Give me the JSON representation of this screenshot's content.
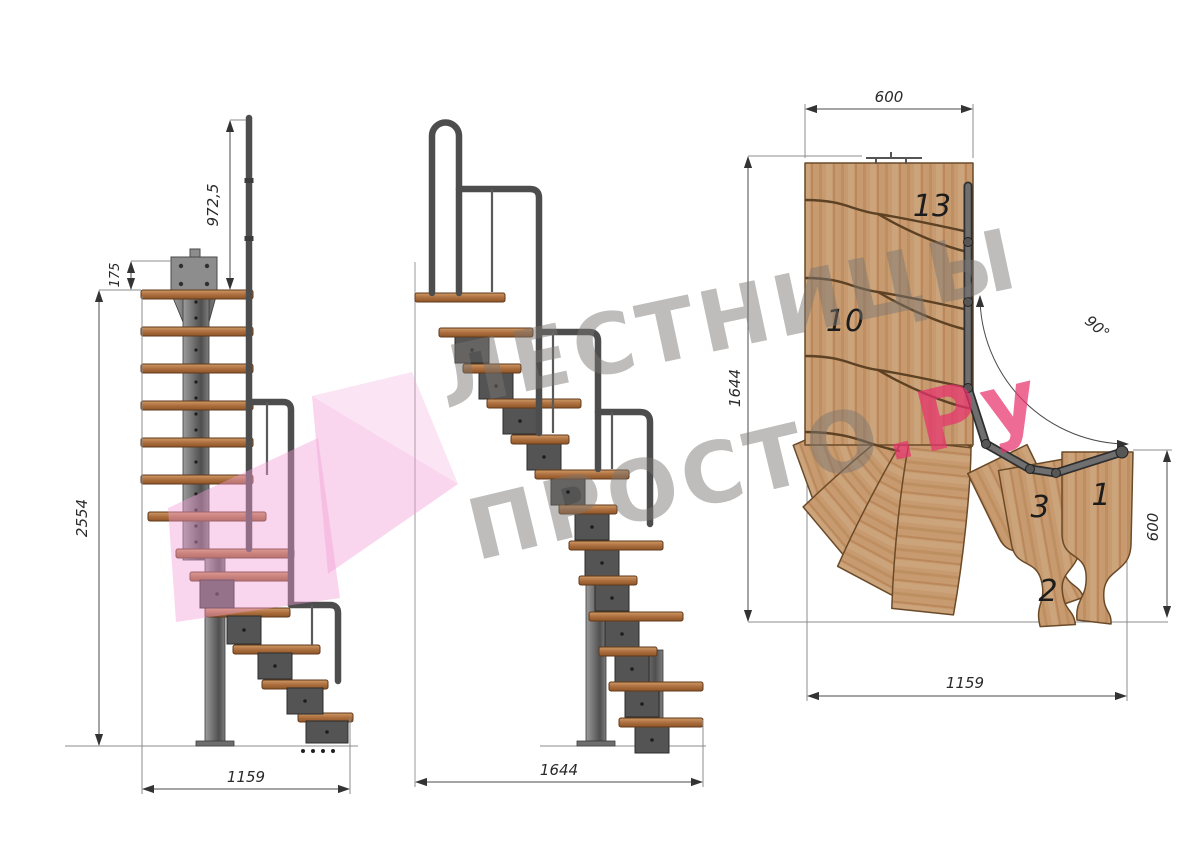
{
  "watermark": {
    "line1": "ЛЕСТНИЦЫ",
    "line2_gray": "ПРОСТО",
    "line2_pink": ".Ру",
    "text_color": "#9a9693",
    "accent_color": "#e8447a",
    "logo_color": "#f2a0d5"
  },
  "side_view": {
    "dim_handrail_height": "972,5",
    "dim_bracket_offset": "175",
    "dim_total_height": "2554",
    "dim_footprint_width": "1159"
  },
  "front_view": {
    "dim_footprint_length": "1644"
  },
  "plan_view": {
    "dim_landing_width": "600",
    "dim_total_length": "1644",
    "dim_turn_angle": "90°",
    "dim_flight_width": "600",
    "dim_footprint_width": "1159",
    "tread_labels": [
      "13",
      "10",
      "3",
      "1",
      "2"
    ]
  },
  "colors": {
    "background": "#ffffff",
    "wood_plan": "#c79b6f",
    "wood_side": "#ad6f3f",
    "metal_dark": "#4d4d4d",
    "metal_light": "#9c9c9c",
    "dimension_lines": "#4a4a4a"
  }
}
